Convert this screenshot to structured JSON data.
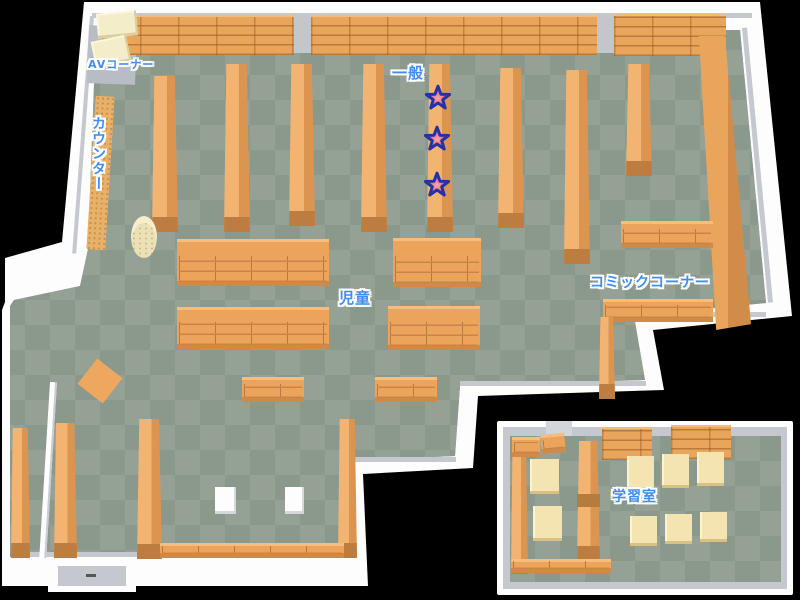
{
  "map": {
    "type": "library-floor-map",
    "areas": {
      "av_corner": {
        "label": "AVコーナー"
      },
      "counter": {
        "label": "カウンター"
      },
      "general": {
        "label": "一般"
      },
      "children": {
        "label": "児童"
      },
      "comic_corner": {
        "label": "コミックコーナー"
      },
      "study_room": {
        "label": "学習室"
      }
    },
    "markers": {
      "shape": "star",
      "count": 3
    },
    "colors": {
      "background": "#000000",
      "wall": "#fdfdfd",
      "wall_shadow": "#c5c9cf",
      "floor_dark": "#8b988c",
      "floor_light": "#96a196",
      "shelf": "#eca75f",
      "shelf_side": "#db9551",
      "furniture_cream": "#f3e4b2",
      "label_text": "#3f8df2",
      "label_outline": "#ffffff",
      "star_fill": "#e8506a",
      "star_outline": "#2233aa"
    }
  }
}
